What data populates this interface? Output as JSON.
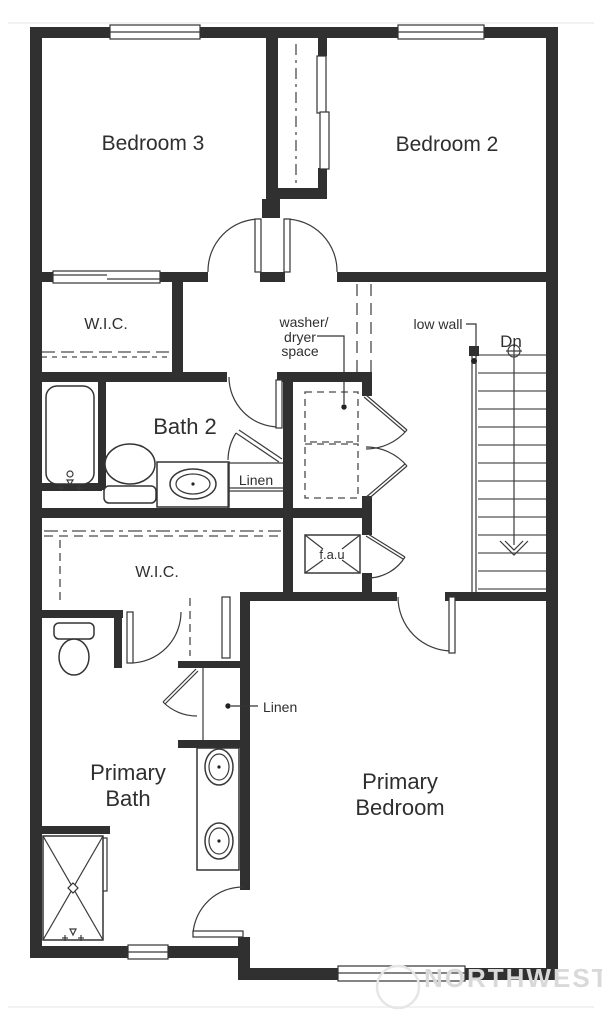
{
  "plan": {
    "rooms": {
      "bedroom3": "Bedroom 3",
      "bedroom2": "Bedroom 2",
      "wic1": "W.I.C.",
      "bath2": "Bath 2",
      "wic2": "W.I.C.",
      "primary_bath_line1": "Primary",
      "primary_bath_line2": "Bath",
      "primary_bedroom_line1": "Primary",
      "primary_bedroom_line2": "Bedroom"
    },
    "annotations": {
      "washer_line1": "washer/",
      "washer_line2": "dryer",
      "washer_line3": "space",
      "low_wall": "low wall",
      "stairs_down": "Dn",
      "linen_bath2": "Linen",
      "linen_primary": "Linen",
      "fau": "f.a.u"
    },
    "stairs": {
      "direction": "Dn",
      "tread_count": 14
    },
    "watermark": {
      "text": "NORTHWEST"
    },
    "colors": {
      "wall": "#303030",
      "line": "#3a3a3a",
      "label_text": "#2f2f2f",
      "watermark": "#d9d9d9",
      "background": "#ffffff"
    }
  }
}
